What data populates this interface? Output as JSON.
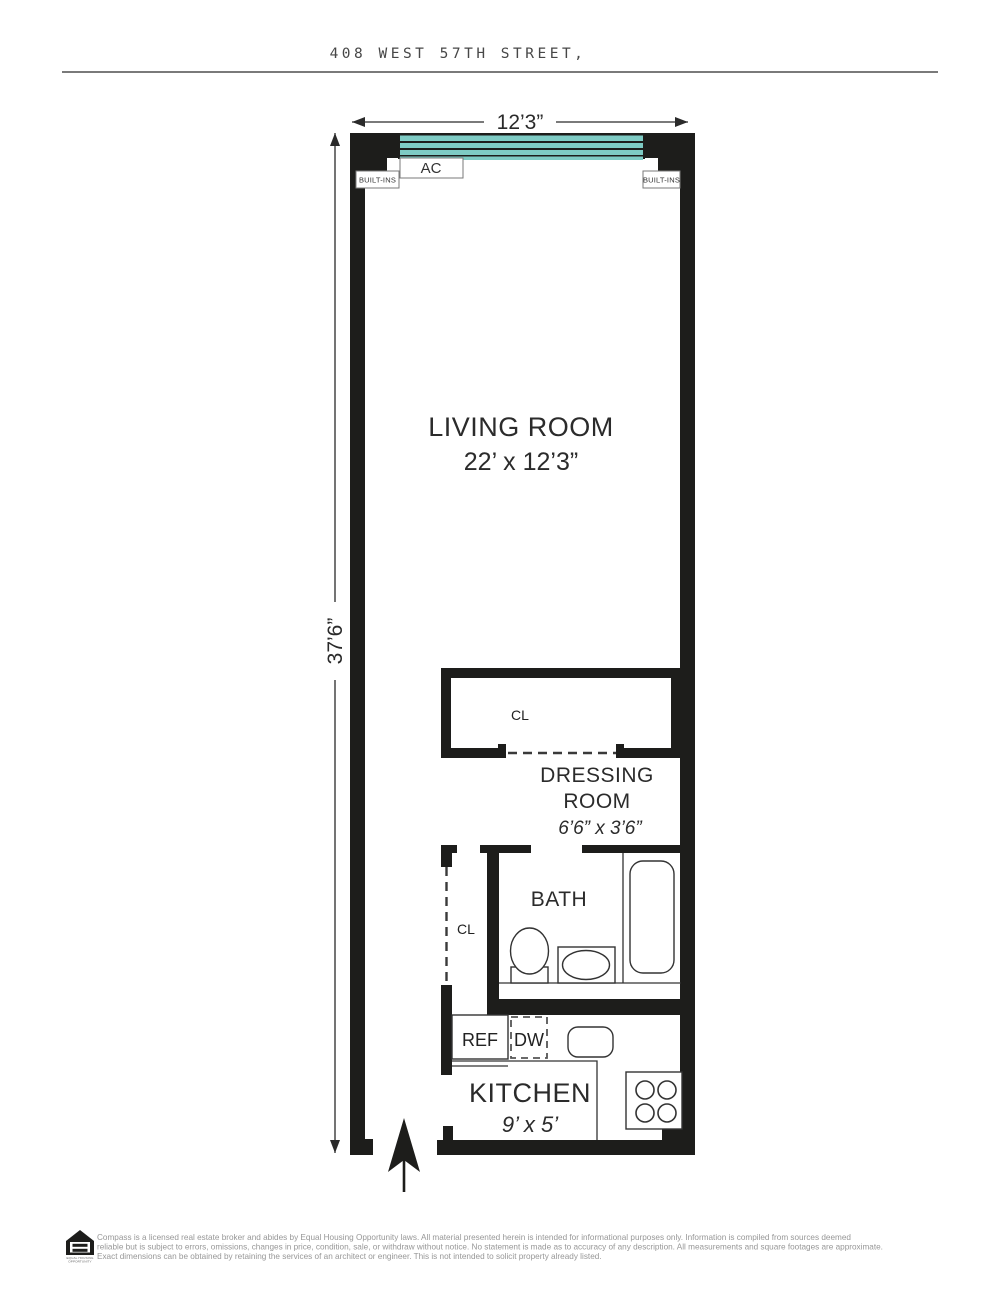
{
  "header": {
    "title": "408 WEST 57TH STREET,"
  },
  "plan": {
    "dim_width": "12’3”",
    "dim_height": "37’6”",
    "living_room": {
      "name": "LIVING ROOM",
      "size": "22’ x 12’3”"
    },
    "dressing_room": {
      "name_line1": "DRESSING",
      "name_line2": "ROOM",
      "size": "6’6” x 3’6”"
    },
    "bath": {
      "name": "BATH"
    },
    "kitchen": {
      "name": "KITCHEN",
      "size": "9’ x 5’"
    },
    "labels": {
      "ac": "AC",
      "built_ins_left": "BUILT-INS",
      "built_ins_right": "BUILT-INS",
      "closet_dressing": "CL",
      "closet_hall": "CL",
      "refrigerator": "REF",
      "dishwasher": "DW"
    },
    "colors": {
      "wall": "#1d1d1b",
      "window": "#7ecbc4"
    }
  },
  "footer": {
    "logo_caption_line1": "EQUAL HOUSING",
    "logo_caption_line2": "OPPORTUNITY",
    "disclaimer_lines": [
      "Compass is a licensed real estate broker and abides by Equal Housing Opportunity laws. All material presented herein is intended for informational purposes only. Information is compiled from sources deemed",
      "reliable but is subject to errors, omissions, changes in price, condition, sale, or withdraw without notice. No statement is made as to accuracy of any description. All measurements and square footages are approximate.",
      "Exact dimensions can be obtained by retaining the services of an architect or engineer. This is not intended to solicit property already listed."
    ]
  }
}
